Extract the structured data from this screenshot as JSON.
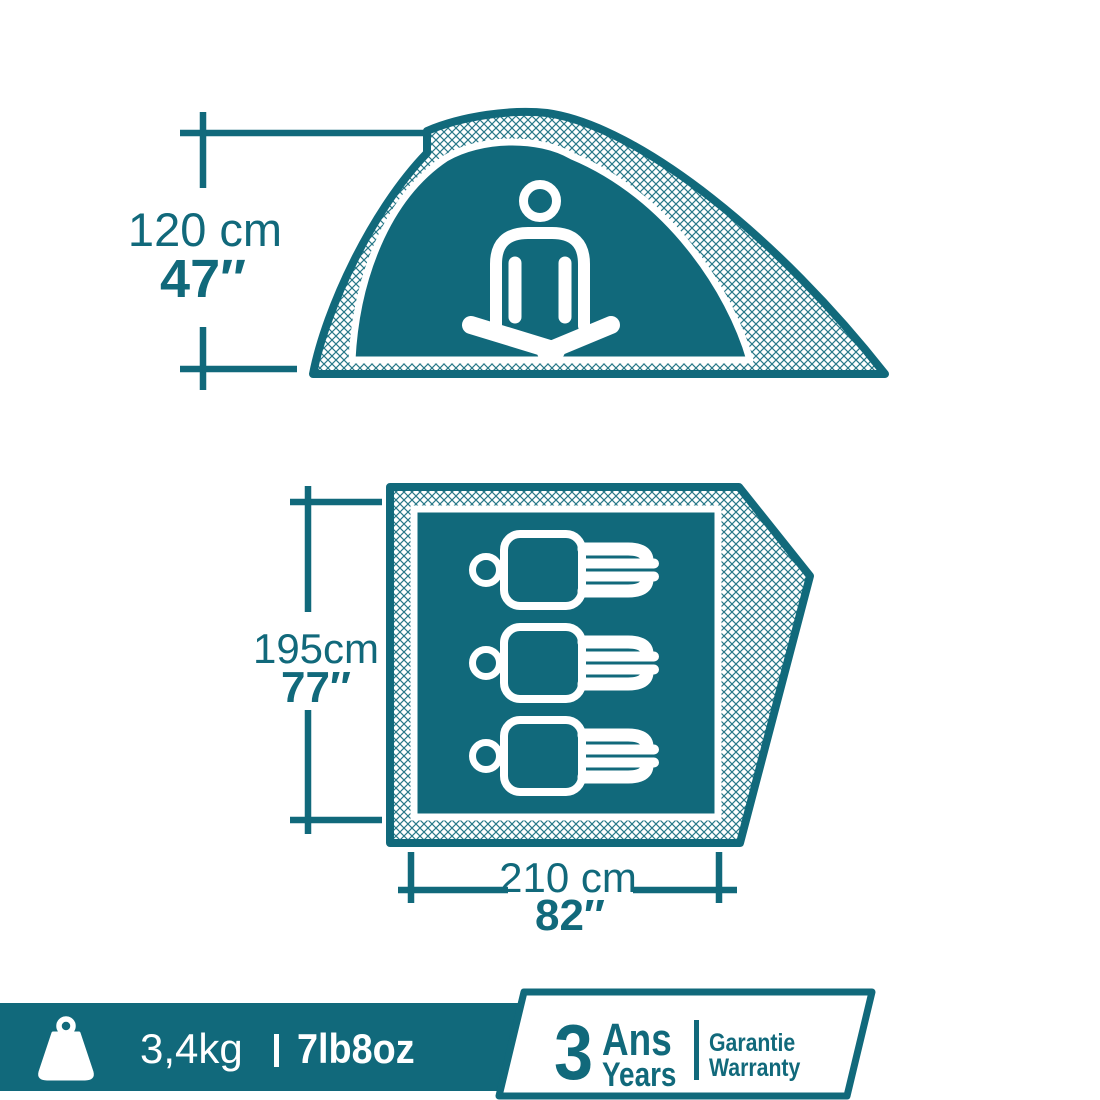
{
  "colors": {
    "teal": "#11697B",
    "white": "#FFFFFF"
  },
  "side_view": {
    "height": {
      "metric": "120 cm",
      "imperial": "47″"
    }
  },
  "floor_plan": {
    "interior_length": {
      "metric": "195cm",
      "imperial": "77″"
    },
    "interior_width": {
      "metric": "210 cm",
      "imperial": "82″"
    },
    "sleeping_capacity": 3
  },
  "footer": {
    "weight": {
      "metric": "3,4kg",
      "imperial": "7lb8oz"
    },
    "warranty": {
      "duration": "3",
      "duration_unit_fr": "Ans",
      "duration_unit_en": "Years",
      "label_fr": "Garantie",
      "label_en": "Warranty"
    }
  },
  "icons": {
    "weight": "kettlebell-weight-icon",
    "side_occupant": "meditating-person-icon",
    "floor_occupant": "lying-person-icon"
  }
}
